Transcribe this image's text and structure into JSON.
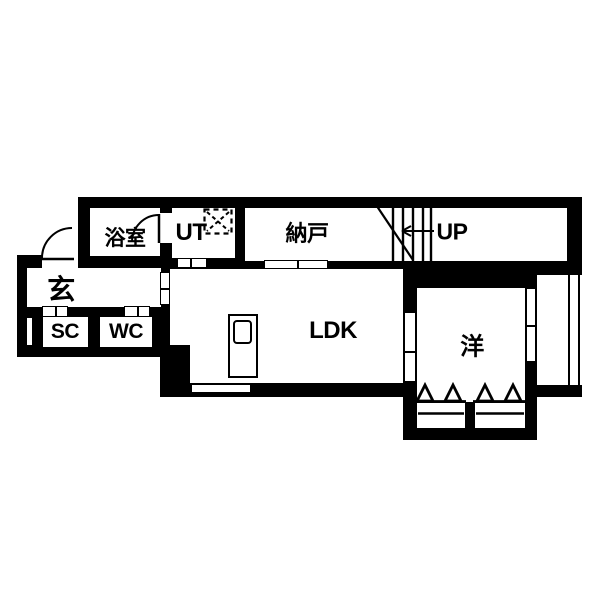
{
  "colors": {
    "wall": "#000000",
    "floor": "#ffffff"
  },
  "rooms": {
    "bathroom": {
      "label": "浴室"
    },
    "utility": {
      "label": "UT"
    },
    "storage_room": {
      "label": "納戸"
    },
    "stair_hall": {
      "label": "UP"
    },
    "entrance": {
      "label": "玄"
    },
    "shoe_closet": {
      "label": "SC"
    },
    "toilet": {
      "label": "WC"
    },
    "living_dining_kitchen": {
      "label": "LDK"
    },
    "western_room": {
      "label": "洋"
    }
  }
}
